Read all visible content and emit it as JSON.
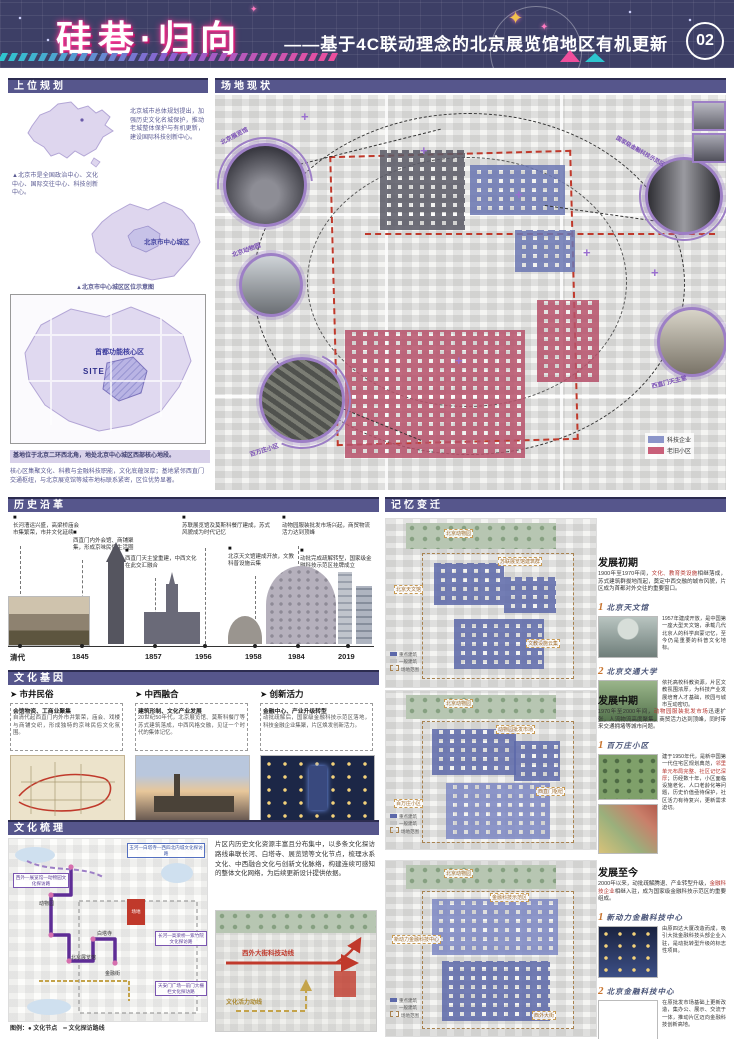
{
  "header": {
    "title": "硅巷·归向",
    "subtitle": "——基于4C联动理念的北京展览馆地区有机更新",
    "page_number": "02"
  },
  "upper": {
    "title": "上位规划",
    "china_caption": "北京城市总体规划提出，加强历史文化名城保护，推动老城整体保护与有机更新，建设国际科技创新中心。",
    "beijing_note": "▲北京市是全国政治中心、文化中心、国际交往中心、科技创新中心。",
    "beijing_map_label": "北京市中心城区",
    "beijing_map_caption": "▲北京市中心城区区位示意图",
    "core_map_label": "首都功能核心区",
    "site_label": "SITE",
    "highlight": "基地位于北京二环西北角，地处北京中心城区西部核心地段。",
    "note": "核心区集聚文化、科教与金融科技职能，文化底蕴深厚；基地紧邻西直门交通枢纽，与北京展览馆等城市地标联系紧密，区位优势显著。"
  },
  "site": {
    "title": "场地现状",
    "callouts": [
      "北京展览馆",
      "北京动物园",
      "百万庄小区",
      "国家级金融科技示范区",
      "西直门天主堂"
    ],
    "legend": [
      {
        "label": "科技企业"
      },
      {
        "label": "老旧小区"
      }
    ]
  },
  "history": {
    "title": "历史沿革",
    "years": [
      "清代",
      "1845",
      "1857",
      "1956",
      "1958",
      "1984",
      "2019"
    ],
    "events": [
      "长河漕运兴盛，高梁桥庙会市集繁荣，市井文化延续",
      "西直门内外会馆、商铺聚集，形成京味民俗生活圈",
      "西直门天主堂重建，中西文化在此交汇融合",
      "苏联展览馆及莫斯科餐厅建成，苏式风貌成为时代记忆",
      "北京天文馆建成开放，文教科普设施云集",
      "动物园服装批发市场兴起，商贸物流活力达到顶峰",
      "动批完成疏解转型，国家级金融科技示范区挂牌成立"
    ]
  },
  "gene": {
    "title": "文化基因",
    "columns": [
      {
        "heading": "市井民俗",
        "lead": "会馆物资、工商业聚集",
        "body": "自清代起西直门内外市井繁荣，庙会、戏楼与商铺交织，形成独特的京味民俗文化氛围。"
      },
      {
        "heading": "中西融合",
        "lead": "建筑形制、文化产业发展",
        "body": "20世纪50年代，北京展览馆、莫斯科餐厅等苏式建筑落成，中西风格交融，见证一个时代的集体记忆。"
      },
      {
        "heading": "创新活力",
        "lead": "金融中心、产业升级转型",
        "body": "动批疏解后，国家级金融科技示范区落地，科技金融企业集聚，片区焕发创新活力。"
      }
    ]
  },
  "sort": {
    "title": "文化梳理",
    "paragraph": "片区内历史文化资源丰富且分布集中，以多条文化探访路线串联长河、白塔寺、展览馆等文化节点，梳理水系文化、中西融合文化与创新文化脉络，构建连续可感知的整体文化网络，为后续更新设计提供依据。",
    "routes": [
      "西外—展览馆—动物园文化探访路",
      "玉河—白塔寺—西四北内城文化探访路",
      "长河—高梁桥—紫竹院文化探访路",
      "天安门广场—前门大栅栏文化探访路"
    ],
    "site_tag": "场地",
    "map_nodes": [
      "动物园",
      "北京展览馆",
      "白塔寺",
      "金融街"
    ],
    "legend": "图例：● 文化节点　━ 文化探访路线",
    "flow_red": "西外大街科技动线",
    "flow_yellow": "文化活力动线"
  },
  "memory": {
    "title": "记忆变迁",
    "map_legend": [
      "重点建筑",
      "一般建筑",
      "场地范围"
    ],
    "stages": [
      {
        "heading": "发展初期",
        "para_a": "1900年至1970年间，",
        "para_red": "文化、教育类设施",
        "para_b": "相继落成，苏式建筑群拔地而起，奠定中西交融的城市风貌，片区成为首都对外交往的重要窗口。",
        "maps_labels": [
          "北京动物园",
          "苏联展览馆建筑群",
          "北京天文馆",
          "文教设施云集"
        ],
        "items": [
          {
            "num": "1",
            "label": "北京天文馆",
            "text": "1957年建成开放，是中国第一座大型天文馆，承载几代北京人的科学启蒙记忆，至今仍是重要的科普文化地标。"
          },
          {
            "num": "2",
            "label": "北京交通大学",
            "text": "依托高校科教资源，片区文教氛围浓厚，为科技产业发展培育人才基础，校园与城市互动密切。"
          }
        ]
      },
      {
        "heading": "发展中期",
        "para_a": "1970年至2000年间，",
        "para_red": "动物园服装批发市场",
        "para_b": "迅速扩张，人流物流高度聚集，商贸活力达到顶峰，同时带来交通拥堵等城市问题。",
        "maps_labels": [
          "北京动物园",
          "动物园批发市场",
          "百万庄小区",
          "西直门枢纽"
        ],
        "items": [
          {
            "num": "1",
            "label": "百万庄小区",
            "text_a": "建于1950年代，是新中国第一代住宅区规划典范，",
            "text_red": "邻里单元布局完整、社区记忆深厚",
            "text_b": "；历经数十年，小区面临设施老化、人口老龄化等问题，历史价值亟待保护，社区活力有待复兴，更新需求迫切。"
          }
        ]
      },
      {
        "heading": "发展至今",
        "para_a": "2000年以来，动批疏解腾退、产业转型升级，",
        "para_red": "金融科技企业",
        "para_b": "相继入驻，成为国家级金融科技示范区的重要组成。",
        "maps_labels": [
          "北京动物园",
          "金融科技示范区",
          "新动力金融科技中心",
          "西外大街"
        ],
        "items": [
          {
            "num": "1",
            "label": "新动力金融科技中心",
            "text": "由原四达大厦改造而成，吸引大批金融科技头部企业入驻，是动批转型升级的标志性项目。"
          },
          {
            "num": "2",
            "label": "北京金融科技中心",
            "text": "在原批发市场基础上更新改造，集办公、展示、交流于一体，推动片区迈向金融科技创新高地。"
          }
        ]
      }
    ]
  }
}
